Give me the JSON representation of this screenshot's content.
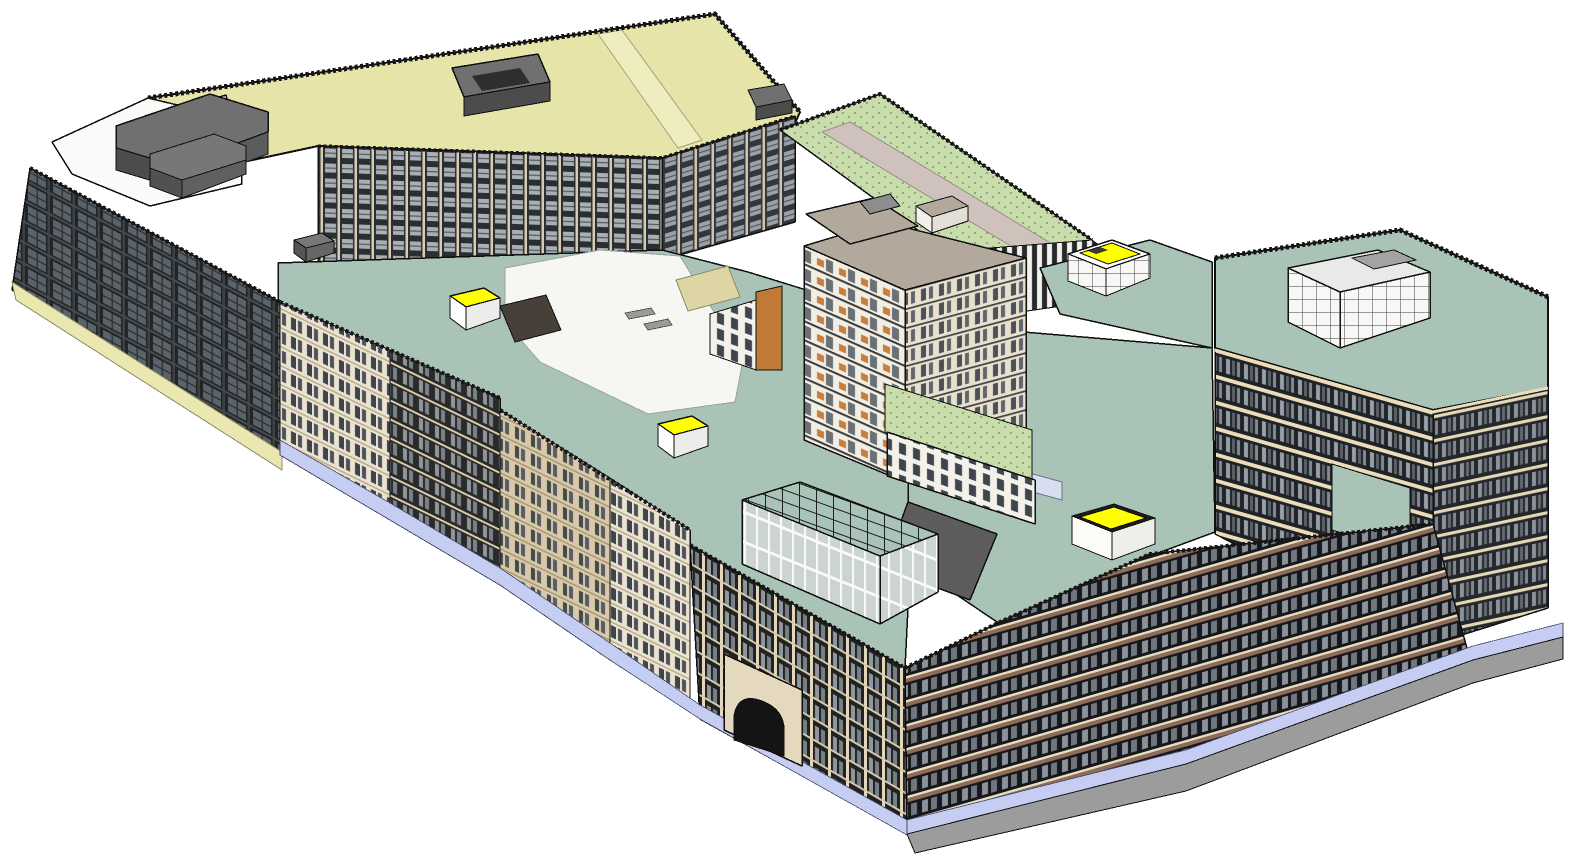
{
  "scene": {
    "description": "3D axonometric architectural model of a city-block building complex with courtyards, green and teal roofs, rooftop penthouses and yellow skylights",
    "canvas": {
      "width": 1574,
      "height": 859,
      "background": "#ffffff"
    }
  },
  "palette": {
    "background": "#ffffff",
    "khaki_roof": "#e7e4a9",
    "khaki_podium": "#eae7b0",
    "white_roof": "#fafaf8",
    "plaza_white": "#f6f6f3",
    "teal_roof": "#a9c3b7",
    "green_roof": "#c9dcab",
    "taupe_roof": "#b2a89b",
    "penthouse_gray": "#707070",
    "penthouse_gray_dark": "#4c4c4c",
    "skylight_yellow": "#ffff00",
    "storefront_lavender": "#c6cdf2",
    "base_gray": "#9c9c9c",
    "walkway_mauve": "#cfc2bc",
    "outline": "#101010"
  },
  "shapes": [
    {
      "n": "roof-khaki-main",
      "t": "p",
      "pts": "148,98 715,14 800,112 790,134 662,158 318,146 150,182 62,150",
      "f": "$khaki_roof",
      "s": "#101010",
      "w": 2
    },
    {
      "n": "roof-khaki-ridge",
      "t": "p",
      "pts": "598,34 622,30 702,140 678,148",
      "f": "#efecbd",
      "s": "#a6a37b",
      "w": 1
    },
    {
      "n": "parapet-khaki",
      "t": "path",
      "d": "M148,98 L715,14 L800,112",
      "f": "none",
      "s": "#161616",
      "w": 5,
      "da": "3 2.5"
    },
    {
      "n": "roof-white-northwest",
      "t": "p",
      "pts": "52,142 148,98 240,120 242,184 150,206 72,174",
      "f": "$white_roof",
      "s": "#101010",
      "w": 1.5
    },
    {
      "n": "penthouse-nw-glass",
      "t": "p",
      "pts": "148,118 226,95 236,134 158,158",
      "f": "url(#patGlassGrid)",
      "s": "#101010",
      "w": 1.5
    },
    {
      "n": "penthouse-nw-top",
      "t": "p",
      "pts": "116,126 210,94 268,112 268,132 176,166 116,148",
      "f": "$penthouse_gray",
      "s": "#101010",
      "w": 1.5
    },
    {
      "n": "penthouse-nw-front",
      "t": "p",
      "pts": "116,148 176,166 176,188 116,170",
      "f": "$penthouse_gray_dark",
      "s": "#101010",
      "w": 1
    },
    {
      "n": "penthouse-nw-side",
      "t": "p",
      "pts": "176,166 268,132 268,154 176,188",
      "f": "#5c5c5c",
      "s": "#101010",
      "w": 1
    },
    {
      "n": "penthouse-nw2-top",
      "t": "p",
      "pts": "150,154 214,134 246,146 246,160 182,180 150,168",
      "f": "#777777",
      "s": "#101010",
      "w": 1
    },
    {
      "n": "penthouse-nw2-front",
      "t": "p",
      "pts": "150,168 182,180 182,198 150,186",
      "f": "#515151",
      "s": "#101010",
      "w": 1
    },
    {
      "n": "penthouse-nw2-side",
      "t": "p",
      "pts": "182,180 246,160 246,174 182,198",
      "f": "#606060",
      "s": "#101010",
      "w": 1
    },
    {
      "n": "roofbox-khaki-1-top",
      "t": "p",
      "pts": "452,68 538,54 550,82 464,97",
      "f": "$penthouse_gray",
      "s": "#101010",
      "w": 1.5
    },
    {
      "n": "roofbox-khaki-1-front",
      "t": "p",
      "pts": "464,97 550,82 550,101 464,116",
      "f": "$penthouse_gray_dark",
      "s": "#101010",
      "w": 1
    },
    {
      "n": "roofbox-khaki-1-hatch",
      "t": "p",
      "pts": "472,76 520,68 530,83 482,91",
      "f": "#2e2e2e"
    },
    {
      "n": "roofbox-khaki-2-top",
      "t": "p",
      "pts": "748,90 784,84 792,100 756,107",
      "f": "$penthouse_gray",
      "s": "#101010",
      "w": 1
    },
    {
      "n": "roofbox-khaki-2-front",
      "t": "p",
      "pts": "756,107 792,100 792,113 756,120",
      "f": "$penthouse_gray_dark",
      "s": "#101010",
      "w": 1
    },
    {
      "n": "facade-courtyard-north",
      "t": "p",
      "pts": "318,146 662,158 662,260 318,292",
      "f": "url(#patWinInner)",
      "s": "#101010",
      "w": 1.5
    },
    {
      "n": "facade-courtyard-east",
      "t": "p",
      "pts": "662,158 795,116 795,222 662,260",
      "f": "url(#patWinInnerR)",
      "s": "#101010",
      "w": 1.5
    },
    {
      "n": "parapet-courtyard",
      "t": "path",
      "d": "M318,146 L662,158 L795,116",
      "f": "none",
      "s": "#161616",
      "w": 3.5,
      "da": "3 2.5"
    },
    {
      "n": "roof-teal-west",
      "t": "p",
      "pts": "278,263 662,250 748,272 910,322 910,568 905,668 690,545 690,530 500,410 500,398 278,302",
      "f": "$teal_roof",
      "s": "#101010",
      "w": 1.5
    },
    {
      "n": "plaza-courtyard",
      "t": "p",
      "pts": "505,268 600,250 680,256 714,312 748,334 735,402 648,414 540,362 505,322",
      "f": "$plaza_white",
      "s": "#9aa49e",
      "w": 1
    },
    {
      "n": "plaza-bench-1",
      "t": "p",
      "pts": "625,313 651,308 655,314 629,319",
      "f": "#9a9a9a",
      "s": "#444444",
      "w": 0.8
    },
    {
      "n": "plaza-bench-2",
      "t": "p",
      "pts": "644,324 668,319 672,325 648,330",
      "f": "#9a9a9a",
      "s": "#444444",
      "w": 0.8
    },
    {
      "n": "plaza-stair-block",
      "t": "p",
      "pts": "500,306 546,295 561,330 515,342",
      "f": "#474038",
      "s": "#101010",
      "w": 1
    },
    {
      "n": "plaza-ramp-tan",
      "t": "p",
      "pts": "676,280 728,266 740,297 688,311",
      "f": "#ddd6a4",
      "s": "#8f8a66",
      "w": 1
    },
    {
      "n": "tower-podium-west",
      "t": "p",
      "pts": "710,314 756,300 756,370 710,354",
      "f": "url(#patPodium)",
      "s": "#101010",
      "w": 1
    },
    {
      "n": "tower-balcony-strip-west",
      "t": "p",
      "pts": "756,292 782,286 782,370 756,370",
      "f": "#c07a35",
      "s": "#101010",
      "w": 1
    },
    {
      "n": "roof-green-north",
      "t": "p",
      "pts": "780,130 880,94 1092,240 1000,290",
      "f": "url(#patGreen)",
      "s": "#101010",
      "w": 1.5
    },
    {
      "n": "parapet-green-north",
      "t": "path",
      "d": "M780,130 L880,94 L1092,240",
      "f": "none",
      "s": "#161616",
      "w": 4,
      "da": "3 2.5"
    },
    {
      "n": "roof-walkway-north",
      "t": "p",
      "pts": "822,132 850,122 1062,250 1034,260",
      "f": "$walkway_mauve",
      "s": "#9b8e88",
      "w": 1
    },
    {
      "n": "rooftop-box-north-top",
      "t": "p",
      "pts": "916,206 952,196 968,206 932,217",
      "f": "$taupe_roof",
      "s": "#101010",
      "w": 1
    },
    {
      "n": "rooftop-box-north-front",
      "t": "p",
      "pts": "916,206 932,217 932,233 916,222",
      "f": "#f2f0ea",
      "s": "#101010",
      "w": 1
    },
    {
      "n": "rooftop-box-north-side",
      "t": "p",
      "pts": "932,217 968,206 968,221 932,233",
      "f": "#e2dfd6",
      "s": "#101010",
      "w": 1
    },
    {
      "n": "facade-mid-stripes",
      "t": "p",
      "pts": "940,252 1092,240 1160,292 1020,312",
      "f": "url(#patMidStripe)",
      "s": "#101010",
      "w": 1
    },
    {
      "n": "roof-teal-northeast",
      "t": "p",
      "pts": "1040,268 1150,240 1212,262 1212,348 1060,314",
      "f": "$teal_roof",
      "s": "#101010",
      "w": 1.5
    },
    {
      "n": "skylight-ne-base",
      "t": "p",
      "pts": "1068,254 1112,240 1150,254 1106,269",
      "f": "#fdfdfd",
      "s": "#101010",
      "w": 1.5
    },
    {
      "n": "skylight-ne-top",
      "t": "p",
      "pts": "1080,253 1112,243 1140,254 1108,264",
      "f": "$skylight_yellow",
      "s": "#101010",
      "w": 1
    },
    {
      "n": "skylight-ne-hatch",
      "t": "p",
      "pts": "1088,251 1100,247 1108,250 1096,254",
      "f": "#3a3a3a"
    },
    {
      "n": "skylight-ne-face-sw",
      "t": "p",
      "pts": "1068,254 1106,269 1106,296 1068,281",
      "f": "url(#patGlassGrid)",
      "s": "#101010",
      "w": 1
    },
    {
      "n": "skylight-ne-face-se",
      "t": "p",
      "pts": "1106,269 1150,254 1150,278 1106,296",
      "f": "url(#patGlassGrid)",
      "s": "#101010",
      "w": 1
    },
    {
      "n": "roof-teal-east",
      "t": "p",
      "pts": "1000,330 1212,348 1215,532 1150,556 1000,624 908,562 908,430",
      "f": "$teal_roof",
      "s": "#101010",
      "w": 1.5
    },
    {
      "n": "roof-canopy-strip",
      "t": "p",
      "pts": "1000,465 1062,482 1062,500 1000,483",
      "f": "#d8def2",
      "s": "#6b7280",
      "w": 1
    },
    {
      "n": "tower-face-sw",
      "t": "p",
      "pts": "804,246 905,290 905,482 804,440",
      "f": "url(#patTowerSW)",
      "s": "#101010",
      "w": 1.5
    },
    {
      "n": "tower-face-se",
      "t": "p",
      "pts": "905,290 1026,258 1026,432 905,482",
      "f": "url(#patTowerSE)",
      "s": "#101010",
      "w": 1.5
    },
    {
      "n": "tower-roof-top",
      "t": "p",
      "pts": "804,246 884,222 1026,258 905,290",
      "f": "$taupe_roof",
      "s": "#101010",
      "w": 1.5
    },
    {
      "n": "tower-roof-upper",
      "t": "p",
      "pts": "806,214 874,198 918,226 850,244",
      "f": "$taupe_roof",
      "s": "#101010",
      "w": 1.5
    },
    {
      "n": "tower-roof-upper-box",
      "t": "p",
      "pts": "860,202 890,194 900,206 870,214",
      "f": "#8d8d8d",
      "s": "#101010",
      "w": 1
    },
    {
      "n": "roof-green-southeast",
      "t": "p",
      "pts": "885,384 1032,430 1032,480 940,470 885,432",
      "f": "url(#patGreen)",
      "s": "#101010",
      "w": 1
    },
    {
      "n": "tower-podium-face",
      "t": "p",
      "pts": "887,432 1035,480 1035,524 887,476",
      "f": "url(#patPodium)",
      "s": "#101010",
      "w": 1.5
    },
    {
      "n": "roof-ramp-dark",
      "t": "p",
      "pts": "908,502 997,534 970,600 884,568",
      "f": "#5d5d5d",
      "s": "#101010",
      "w": 1.5
    },
    {
      "n": "atrium-roof-grid",
      "t": "p",
      "pts": "742,500 800,482 938,534 880,556",
      "f": "url(#patAtriumGrid)",
      "s": "#101010",
      "w": 1.5
    },
    {
      "n": "atrium-face-front",
      "t": "p",
      "pts": "742,500 880,556 880,624 742,564",
      "f": "url(#patAtriumFront)",
      "s": "#101010",
      "w": 1.5
    },
    {
      "n": "atrium-face-side",
      "t": "p",
      "pts": "880,556 938,534 938,592 880,624",
      "f": "url(#patAtriumFront)",
      "s": "#101010",
      "w": 1.5
    },
    {
      "n": "skylight-west-top",
      "t": "p",
      "pts": "450,296 484,288 500,298 466,307",
      "f": "$skylight_yellow",
      "s": "#101010",
      "w": 1.5
    },
    {
      "n": "skylight-west-face-sw",
      "t": "p",
      "pts": "450,296 466,307 466,330 450,318",
      "f": "#fdfdfd",
      "s": "#101010",
      "w": 1
    },
    {
      "n": "skylight-west-face-se",
      "t": "p",
      "pts": "466,307 500,298 500,318 466,330",
      "f": "#ececea",
      "s": "#101010",
      "w": 1
    },
    {
      "n": "skylight-center-top",
      "t": "p",
      "pts": "658,424 692,416 708,426 674,435",
      "f": "$skylight_yellow",
      "s": "#101010",
      "w": 1.5
    },
    {
      "n": "skylight-center-face-sw",
      "t": "p",
      "pts": "658,424 674,435 674,458 658,446",
      "f": "#fdfdfd",
      "s": "#101010",
      "w": 1
    },
    {
      "n": "skylight-center-face-se",
      "t": "p",
      "pts": "674,435 708,426 708,446 674,458",
      "f": "#ececea",
      "s": "#101010",
      "w": 1
    },
    {
      "n": "skylight-east-rim",
      "t": "p",
      "pts": "1072,516 1114,504 1155,518 1112,532",
      "f": "#1d1d1d",
      "s": "#101010",
      "w": 1
    },
    {
      "n": "skylight-east-top",
      "t": "p",
      "pts": "1080,517 1114,507 1146,518 1111,529",
      "f": "$skylight_yellow",
      "s": "#101010",
      "w": 1
    },
    {
      "n": "skylight-east-face-sw",
      "t": "p",
      "pts": "1072,516 1112,532 1112,560 1072,544",
      "f": "#fbfbf8",
      "s": "#101010",
      "w": 1
    },
    {
      "n": "skylight-east-face-se",
      "t": "p",
      "pts": "1112,532 1155,518 1155,544 1112,560",
      "f": "#eeeeea",
      "s": "#101010",
      "w": 1
    },
    {
      "n": "rooftop-box-west-top",
      "t": "p",
      "pts": "294,240 322,233 334,241 306,248",
      "f": "#787878",
      "s": "#101010",
      "w": 1
    },
    {
      "n": "rooftop-box-west-front",
      "t": "p",
      "pts": "294,240 306,248 306,262 294,253",
      "f": "#565656",
      "s": "#101010",
      "w": 1
    },
    {
      "n": "rooftop-box-west-side",
      "t": "p",
      "pts": "306,248 334,241 334,253 306,262",
      "f": "#666666",
      "s": "#101010",
      "w": 1
    },
    {
      "n": "roof-east-tower",
      "t": "p",
      "pts": "1215,258 1400,230 1548,297 1548,388 1433,410 1215,348",
      "f": "$teal_roof",
      "s": "#101010",
      "w": 2
    },
    {
      "n": "parapet-east-tower",
      "t": "path",
      "d": "M1215,258 L1400,230 L1548,297",
      "f": "none",
      "s": "#161616",
      "w": 5,
      "da": "3 2.5"
    },
    {
      "n": "east-penthouse-top",
      "t": "p",
      "pts": "1288,268 1378,250 1430,272 1340,292",
      "f": "#e9e9e7",
      "s": "#101010",
      "w": 1.5
    },
    {
      "n": "east-penthouse-roofpatch",
      "t": "p",
      "pts": "1352,258 1394,250 1416,260 1374,269",
      "f": "#a3a3a3",
      "s": "#101010",
      "w": 1
    },
    {
      "n": "east-penthouse-face-sw",
      "t": "p",
      "pts": "1288,268 1340,292 1340,348 1288,322",
      "f": "url(#patGlassGrid)",
      "s": "#101010",
      "w": 1.5
    },
    {
      "n": "east-penthouse-face-se",
      "t": "p",
      "pts": "1340,292 1430,272 1430,318 1340,348",
      "f": "url(#patGlassGrid)",
      "s": "#101010",
      "w": 1.5
    },
    {
      "n": "east-tower-face-sw",
      "t": "p",
      "pts": "1215,350 1433,412 1433,644 1215,534",
      "f": "url(#patEastSW)",
      "s": "#101010",
      "w": 1.5
    },
    {
      "n": "east-tower-face-se",
      "t": "p",
      "pts": "1433,412 1548,388 1548,608 1433,644",
      "f": "url(#patEastSE)",
      "s": "#101010",
      "w": 1.5
    },
    {
      "n": "east-tower-parapet-cream",
      "t": "path",
      "d": "M1215,350 L1433,412 L1548,388",
      "f": "none",
      "s": "#ecdcba",
      "w": 3
    },
    {
      "n": "east-terrace-teal",
      "t": "p",
      "pts": "1332,464 1410,488 1410,554 1332,530",
      "f": "$teal_roof",
      "s": "#101010",
      "w": 1
    },
    {
      "n": "facade-se-wing",
      "t": "p",
      "pts": "905,668 1000,622 1150,554 1433,524 1468,652 1186,764 907,834",
      "f": "url(#patFacadeSE)",
      "s": "#101010",
      "w": 1.5
    },
    {
      "n": "parapet-se-wing",
      "t": "path",
      "d": "M905,668 L1000,622 L1150,554 L1433,524",
      "f": "none",
      "s": "#161616",
      "w": 4,
      "da": "3 2.5"
    },
    {
      "n": "storefront-band-se",
      "t": "p",
      "pts": "907,820 1186,750 1473,646 1563,623 1563,638 1473,661 1186,765 907,835",
      "f": "$storefront_lavender",
      "s": "#444a6b",
      "w": 0.8
    },
    {
      "n": "base-plinth-se",
      "t": "p",
      "pts": "907,834 1186,764 1473,660 1563,637 1563,659 1473,683 1186,791 915,853",
      "f": "$base_gray",
      "s": "#101010",
      "w": 1
    },
    {
      "n": "facade-sw-left-wing",
      "t": "p",
      "pts": "30,168 280,302 280,455 12,290",
      "f": "url(#patWinBig)",
      "s": "#101010",
      "w": 1.5
    },
    {
      "n": "parapet-sw-left",
      "t": "path",
      "d": "M30,168 L280,302",
      "f": "none",
      "s": "#161616",
      "w": 4,
      "da": "3 2.5"
    },
    {
      "n": "podium-strip-left",
      "t": "p",
      "pts": "12,282 282,452 282,470 16,300",
      "f": "$khaki_podium",
      "s": "#8f8a66",
      "w": 1
    },
    {
      "n": "facade-street-1",
      "t": "p",
      "pts": "280,302 390,350 390,520 280,455",
      "f": "url(#patStreetCream)",
      "s": "#101010",
      "w": 1
    },
    {
      "n": "facade-street-2",
      "t": "p",
      "pts": "390,350 500,398 500,585 390,520",
      "f": "url(#patStreetDark)",
      "s": "#101010",
      "w": 1
    },
    {
      "n": "facade-street-3",
      "t": "p",
      "pts": "500,410 610,478 610,660 500,585",
      "f": "url(#patStreetTan)",
      "s": "#101010",
      "w": 1
    },
    {
      "n": "facade-street-4",
      "t": "p",
      "pts": "610,478 690,530 690,712 610,660",
      "f": "url(#patStreetCream)",
      "s": "#101010",
      "w": 1
    },
    {
      "n": "facade-street-corner",
      "t": "p",
      "pts": "690,545 905,668 907,834 700,719",
      "f": "url(#patStreetCorner)",
      "s": "#101010",
      "w": 1.5
    },
    {
      "n": "parapet-street",
      "t": "path",
      "d": "M280,302 L500,398 M500,410 L690,530 M690,545 L905,668",
      "f": "none",
      "s": "#161616",
      "w": 4,
      "da": "3 2.5"
    },
    {
      "n": "storefront-band-sw",
      "t": "p",
      "pts": "280,440 390,503 500,568 610,643 700,705 907,820 907,835 700,719 610,660 500,585 390,520 280,455",
      "f": "$storefront_lavender",
      "s": "#444a6b",
      "w": 0.8
    },
    {
      "n": "arch-block",
      "t": "p",
      "pts": "724,654 802,690 802,766 724,730",
      "f": "#e4d9bf",
      "s": "#101010",
      "w": 1.5
    },
    {
      "n": "arch-opening",
      "t": "path",
      "d": "M734,716 Q738,692 762,701 Q786,710 784,734 L784,756 L734,740 Z",
      "f": "#141414",
      "s": "#101010",
      "w": 1
    }
  ]
}
